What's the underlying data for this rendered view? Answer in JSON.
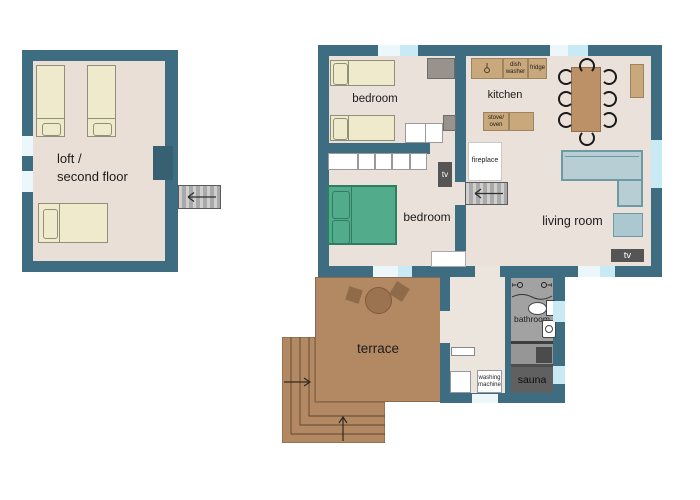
{
  "colors": {
    "wall": "#3e6c80",
    "wall_dark": "#376073",
    "floor": "#e9e1da",
    "floor_hall": "#ebe5dd",
    "floor_loft": "#eadfd7",
    "window_pale": "#ecf7fb",
    "window_cyan": "#c8eaf4",
    "bed_cream": "#eeeacb",
    "bed_cream_border": "#90907a",
    "bed_green": "#52ab8b",
    "bed_green_border": "#2f7d63",
    "tan": "#c9a87c",
    "tan_border": "#9c8460",
    "table_wood": "#bd9168",
    "terrace": "#b28963",
    "terrace_dark": "#9c7351",
    "sofa": "#b7ced4",
    "sofa_border": "#6f9aa3",
    "tv_dark": "#555555",
    "stairs": "#bdbdbd",
    "bath_gray": "#a2a2a2",
    "sauna_floor": "#606060",
    "sauna_stove": "#4b4b4b"
  },
  "loft": {
    "label_line1": "loft /",
    "label_line2": "second floor"
  },
  "rooms": {
    "bedroom_top": "bedroom",
    "bedroom_main": "bedroom",
    "kitchen": "kitchen",
    "living_room": "living room",
    "bathroom": "bathroom",
    "sauna": "sauna",
    "terrace": "terrace"
  },
  "fixtures": {
    "fireplace": "fireplace",
    "tv_living": "tv",
    "tv_bedroom": "tv",
    "dish_washer": [
      "dish",
      "washer"
    ],
    "fridge": "fridge",
    "stove_oven": [
      "stove/",
      "oven"
    ],
    "washing_machine": [
      "washing",
      "machine"
    ]
  }
}
